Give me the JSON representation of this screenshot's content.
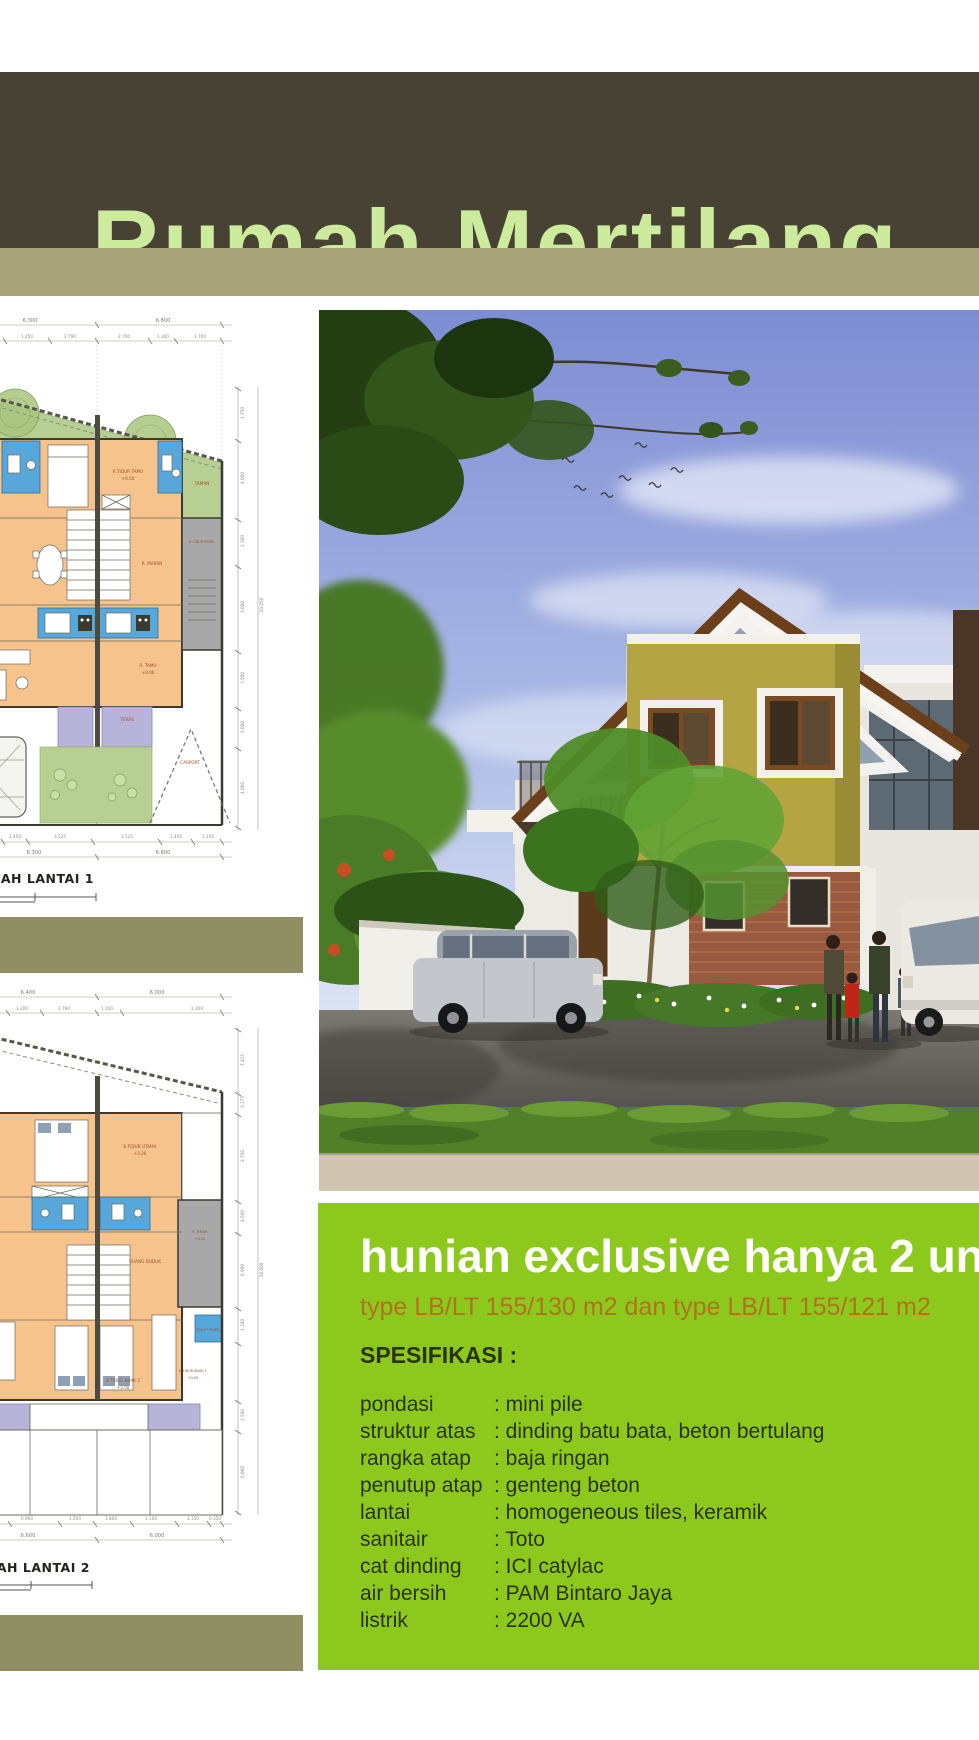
{
  "header": {
    "title": "Rumah Mertilang"
  },
  "promo": {
    "headline": "hunian exclusive hanya 2 unit",
    "subheadline": "type LB/LT 155/130 m2 dan type LB/LT 155/121 m2",
    "spec_title": "SPESIFIKASI :",
    "specs": [
      {
        "label": "pondasi",
        "value": ": mini pile"
      },
      {
        "label": "struktur atas",
        "value": ": dinding batu bata, beton bertulang"
      },
      {
        "label": "rangka atap",
        "value": ": baja ringan"
      },
      {
        "label": "penutup atap",
        "value": ": genteng beton"
      },
      {
        "label": "lantai",
        "value": ": homogeneous tiles, keramik"
      },
      {
        "label": "sanitair",
        "value": ": Toto"
      },
      {
        "label": "cat dinding",
        "value": ": ICI catylac"
      },
      {
        "label": "air bersih",
        "value": ": PAM Bintaro Jaya"
      },
      {
        "label": "listrik",
        "value": ": 2200 VA"
      }
    ]
  },
  "plan1": {
    "title": "DENAH LANTAI 1",
    "rooms": {
      "taman": "TAMAN",
      "tidur_tamu": "K.TIDUR TAMU",
      "tidur_tamu_lv": "+0.50",
      "makan": "R. MAKAN",
      "tidur_pemb": "K.TIDUR PEMB.",
      "tamu": "R. TAMU",
      "tamu_lv": "+0.00",
      "teras": "TERAS",
      "carport": "CARPORT"
    },
    "dims_top": [
      "6.300",
      "6.800"
    ],
    "dims_top_sub": [
      "1.250",
      "2.790",
      "2.700",
      "1.300",
      "1.700"
    ],
    "dims_bottom_sub": [
      "2.450",
      "3.525",
      "3.525",
      "2.450",
      "1.150"
    ],
    "dims_bottom": [
      "6.300",
      "6.800"
    ],
    "dims_right": [
      "1.750",
      "4.000",
      "2.300",
      "3.000",
      "1.500",
      "2.000",
      "4.000"
    ],
    "dims_right_total": "20.050"
  },
  "plan2": {
    "title": "DENAH LANTAI 2",
    "rooms": {
      "tidur_utama": "K.TIDUR UTAMA",
      "tidur_utama_lv": "+3.20",
      "ruang_duduk": "RUANG DUDUK",
      "jemur": "R. JEMUR",
      "jemur_lv": "+3.20",
      "toilet_pemb": "TOILET PEMB.",
      "tidur_anak2": "K.TIDUR ANAK 2",
      "tidur_anak2_lv": "+3.50",
      "tidur_anak1": "K.TIDUR ANAK 1",
      "tidur_anak1_lv": "+3.20"
    },
    "dims_top": [
      "6.400",
      "6.000"
    ],
    "dims_top_sub": [
      "1.200",
      "2.790",
      "1.100",
      "2.300"
    ],
    "dims_bottom_sub": [
      "0.900",
      "1.200",
      "1.800",
      "1.100",
      "1.150",
      "0.350"
    ],
    "dims_bottom": [
      "6.600",
      "6.000"
    ],
    "dims_right": [
      "7.425",
      "3.175",
      "2.750",
      "4.600",
      "0.900",
      "1.100",
      "1.500",
      "6.000"
    ],
    "dims_right_total": "20.600"
  },
  "colors": {
    "header_bar": "#474233",
    "header_strip": "#a5a377",
    "title_text": "#cdeb9c",
    "divider_olive": "#908f63",
    "panel_green": "#8dc91c",
    "headline_white": "#ffffff",
    "subheadline_orange": "#b0721d",
    "spec_text": "#2a3308",
    "plan_garden": "#b7cf92",
    "plan_floor": "#f6c38d",
    "plan_wet_area": "#57a7da",
    "plan_service": "#a8a8a8",
    "plan_terrace": "#b8b3d9",
    "house_wall_olive": "#b5a444",
    "roof_brown": "#6b3f1a"
  }
}
